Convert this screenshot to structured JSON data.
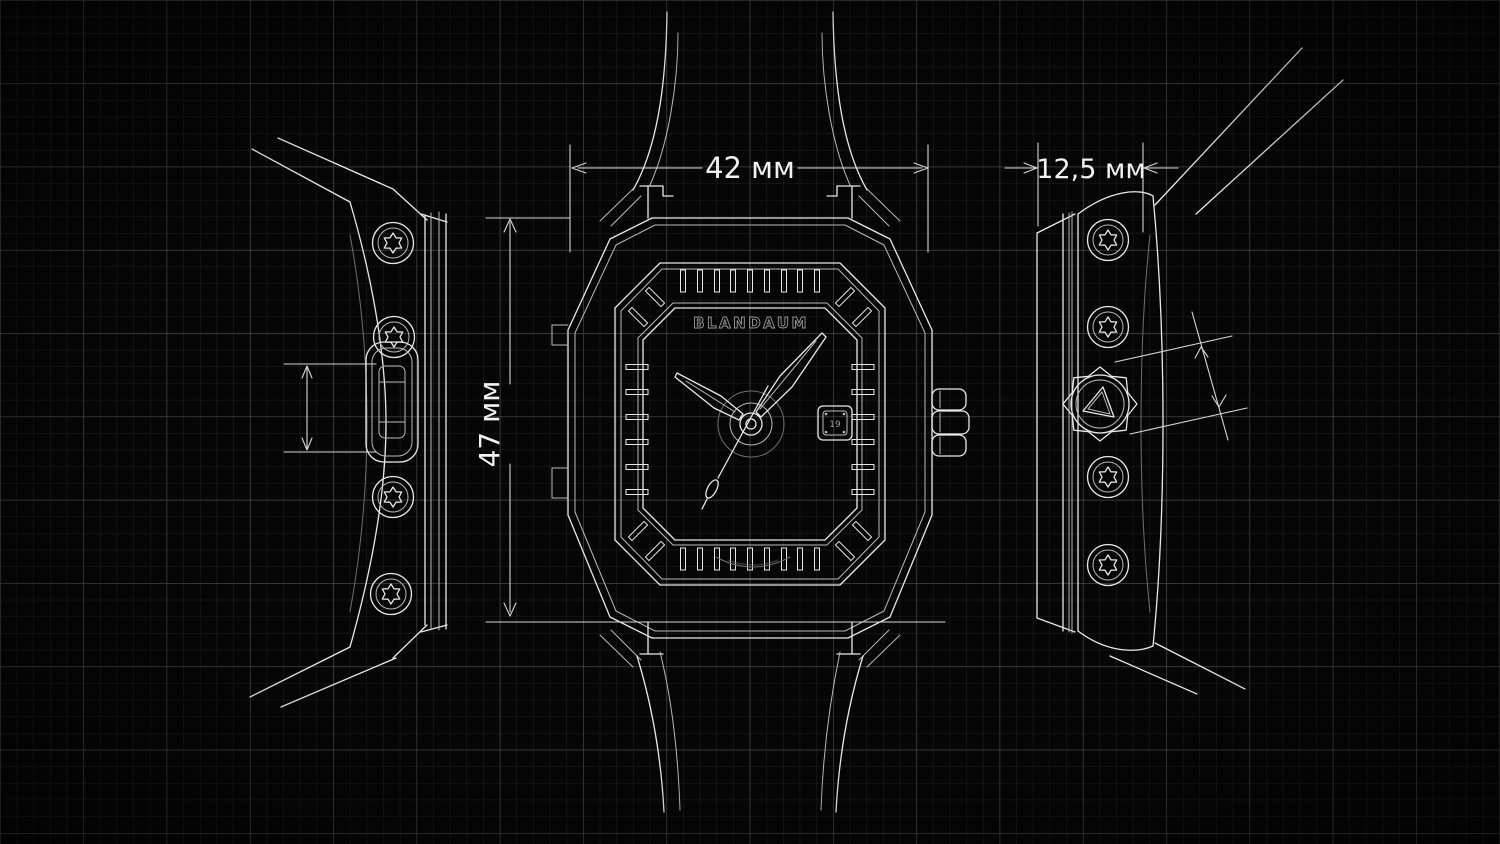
{
  "page": {
    "title": "Wristwatch technical blueprint, three orthographic views"
  },
  "colors": {
    "background": "#060606",
    "grid_minor": "#212121",
    "grid_major": "#4e4e4e",
    "line": "#e9e9e9",
    "line_soft": "#b9b9b9",
    "line_dim": "#d6d6d6",
    "line_faint": "#6f6f6f",
    "text": "#f2f2f2",
    "brand_stroke": "#9a9a9a"
  },
  "dimensions": {
    "case_width": "42 мм",
    "crown_side_width": "12,5 мм",
    "case_height": "47 мм"
  },
  "views": {
    "left_side": {
      "screw_count": 4,
      "feature": "pusher-button"
    },
    "front": {
      "brand": "BLANDAUM",
      "date_value": "19"
    },
    "right_side": {
      "screw_count": 4,
      "feature": "crown"
    }
  }
}
